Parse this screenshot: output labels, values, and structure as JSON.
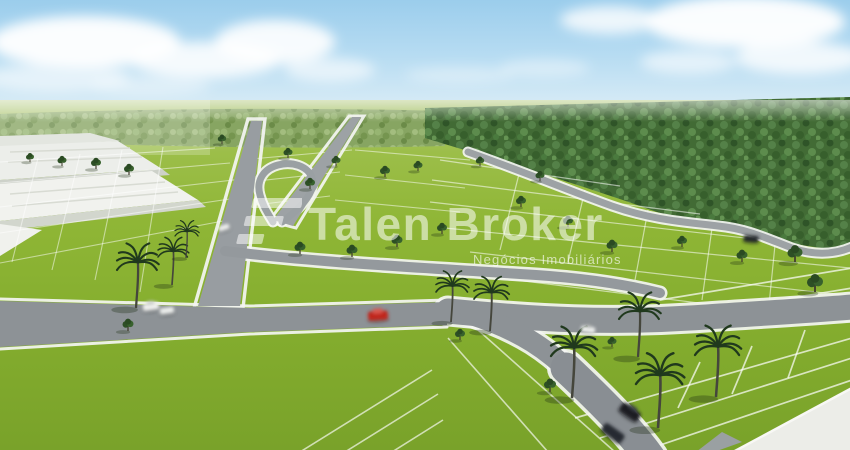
{
  "watermark": {
    "brand": "Talen Broker",
    "tagline": "Negócios Imobiliários",
    "logo_icon": "talen-broker-logo-mark"
  },
  "scene": {
    "description": "Aerial 3D rendering of a vacant-lot land subdivision (loteamento)",
    "elements": [
      "blue sky with white clouds",
      "distant tree line on horizon",
      "dense green forest along right side",
      "white warehouse buildings on left",
      "bright green lots divided by thin white lines",
      "gray curving internal streets with white curbs",
      "palm trees along foreground streets",
      "small round trees on lot corners",
      "red car on main street",
      "white cars near left intersection",
      "dark cars on lower right street",
      "pale wide avenue at bottom right corner"
    ]
  },
  "colors": {
    "sky_top": "#9bcdec",
    "sky_horizon": "#eef5f1",
    "grass_mid": "#8db434",
    "grass_foreground": "#79a22a",
    "forest": "#426b35",
    "road": "#8d9296",
    "curb_white": "#f4f5f3",
    "building_white": "#f0f1ed",
    "pale_avenue": "#ecede8",
    "car_red": "#c0251c",
    "car_dark": "#23262b",
    "car_white": "#f2f2f0",
    "watermark_white": "rgba(255,255,255,0.55)"
  }
}
